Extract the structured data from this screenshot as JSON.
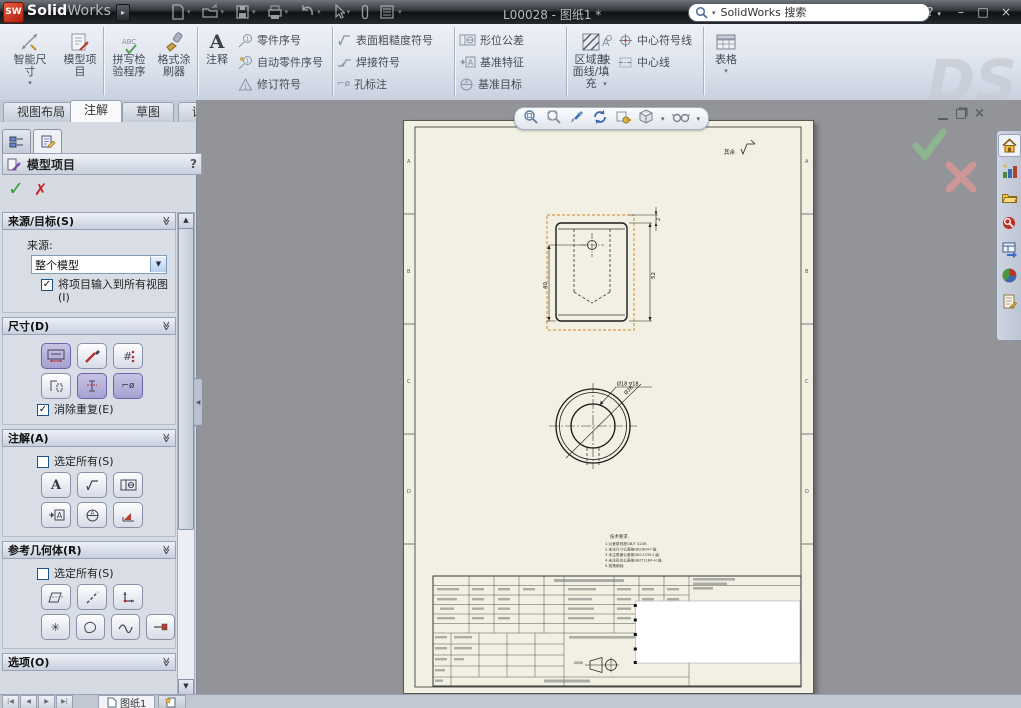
{
  "app": {
    "logo_badge": "SW",
    "logo_text_bold": "Solid",
    "logo_text_light": "Works",
    "document_title": "L00028 - 图纸1 *",
    "search_placeholder": "SolidWorks 搜索",
    "controls": {
      "help": "?",
      "close": "×"
    }
  },
  "quick_icons": [
    "new",
    "open",
    "save",
    "print",
    "undo",
    "select",
    "measure",
    "options"
  ],
  "ribbon": {
    "buttons": {
      "smart_dimension": "智能尺寸",
      "model_items": "模型项目",
      "spell_checker": "拼写检验程序",
      "format_painter": "格式涂刷器",
      "note": "注释",
      "balloon": "零件序号",
      "auto_balloon": "自动零件序号",
      "revision_symbol": "修订符号",
      "surface_finish": "表面粗糙度符号",
      "weld_symbol": "焊接符号",
      "hole_callout": "孔标注",
      "geometric_tolerance": "形位公差",
      "datum_feature": "基准特征",
      "datum_target": "基准目标",
      "area_hatch": "区域剖面线/填充",
      "block": "块",
      "center_mark": "中心符号线",
      "centerline": "中心线",
      "tables": "表格"
    },
    "watermark": "DS"
  },
  "tabs": {
    "items": [
      "视图布局",
      "注解",
      "草图",
      "评估",
      "办公室产品"
    ],
    "active": "注解"
  },
  "pm": {
    "title": "模型项目",
    "help": "?",
    "ok": "✓",
    "cancel": "✗",
    "source": {
      "title": "来源/目标(S)",
      "label": "来源:",
      "value": "整个模型",
      "option": "将项目输入到所有视图(I)"
    },
    "dims": {
      "title": "尺寸(D)",
      "option": "消除重复(E)"
    },
    "annos": {
      "title": "注解(A)",
      "option": "选定所有(S)"
    },
    "refgeo": {
      "title": "参考几何体(R)",
      "option": "选定所有(S)"
    },
    "options": {
      "title": "选项(O)"
    }
  },
  "headsup_icons": [
    "zoom-to-fit",
    "zoom-to-area",
    "previous-view",
    "rotate-view",
    "3d-drawing-view",
    "view-orientation",
    "hide-show-items"
  ],
  "taskpane_icons": [
    "solidworks-resources",
    "design-library",
    "file-explorer",
    "search",
    "view-palette",
    "appearances",
    "custom-properties"
  ],
  "sheet": {
    "dim_height": "52",
    "dim_top": "2",
    "dim_left": "40",
    "hole_callout": "Ø18 ∇18",
    "dim_diameter": "Ø38",
    "finish_note": "其余",
    "zones": [
      "A",
      "B",
      "C",
      "D"
    ],
    "notes": [
      "技术要求.",
      "1.公差原则按GB/T 4249.",
      "2.未注尺寸公差按GB1804-f 级.",
      "3.未注角度公差按GB11335-f 级.",
      "4.未注形位公差按GB/T1184-H 级.",
      "5.锐角倒钝."
    ]
  },
  "bottom": {
    "nav": [
      "|◀",
      "◀",
      "▶",
      "▶|"
    ],
    "sheet_tab": "图纸1"
  },
  "colors": {
    "selection": "#e09a50",
    "paper": "#f1f0e2",
    "highlight_purple": "#b4aed6",
    "ok_green": "#8cbf8c",
    "cancel_red": "#dc9898"
  }
}
